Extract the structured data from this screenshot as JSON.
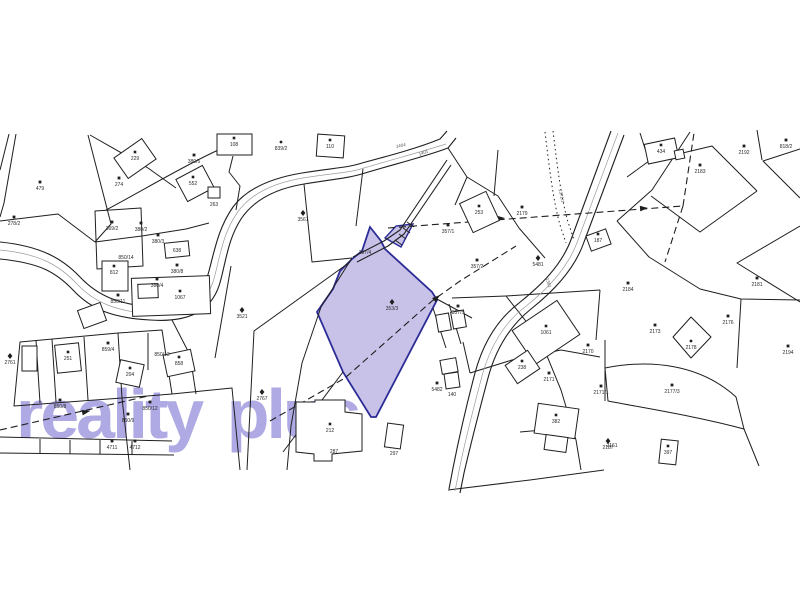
{
  "map": {
    "watermark": {
      "text": "reality plus",
      "color": "#6f66cf",
      "opacity": 0.55
    },
    "colors": {
      "background": "#ffffff",
      "line": "#1f1f1f",
      "road_center": "#9c9c9c",
      "highlight_fill": "#c8c2e9",
      "highlight_stroke": "#2c2c97",
      "label": "#2a2a2a"
    },
    "highlight": {
      "main_parcel": "M370,227 L381,241 L385,249 L432,292 L437,300 L376,417 L371,417 L343,372 L317,312 L333,289 L340,271 L352,259 L362,251 Z",
      "sliver_parcel": "M385,238 L396,226 L413,224 L401,247 Z",
      "label": "353/3"
    },
    "roads": [
      {
        "edges": [
          "M0,242 C40,246 62,258 80,277 C98,296 118,304 152,307 C188,310 202,298 209,271 C215,248 219,227 233,207 C247,188 272,178 302,173 C332,168 347,168 362,163 C392,155 418,148 440,139 L447,131",
          "M0,259 C40,263 56,272 74,291 C92,310 114,318 150,320 C192,323 214,309 221,279 C227,255 229,238 241,219 C253,201 274,189 304,184 C334,179 350,178 365,173 C395,164 424,157 448,148 L456,138"
        ],
        "center": "M0,250 C40,254 59,265 77,284 C95,303 116,311 151,314 C190,317 208,304 215,275 C221,251 224,232 237,213 C250,194 273,183 303,178 C333,173 349,173 364,168 C394,159 421,152 446,144"
      },
      {
        "edges": [
          "M611,131 L572,237 C562,266 539,287 519,303 C498,319 483,343 475,373 C467,403 459,438 453,468 L449,489",
          "M624,135 L584,242 C574,271 551,293 531,309 C511,325 496,348 488,378 C480,408 471,443 464,473 L460,493"
        ],
        "center": "M618,133 L578,240 C568,269 545,291 525,307 C505,322 490,346 482,376 C474,406 465,441 459,471 L455,491"
      },
      {
        "edges": [
          "M447,160 L400,230 L384,241 L353,257",
          "M451,165 L404,234 L388,246 L357,262"
        ],
        "center": null
      }
    ],
    "bridge_ticks": [
      "M395,240 L402,245",
      "M399,234 L406,239",
      "M403,228 L410,233",
      "M407,222 L414,227"
    ],
    "boundaries": [
      "M88,135 L111,224 L95,242",
      "M9,134 L0,170",
      "M16,134 L4,203 L0,217",
      "M95,242 L142,236 L186,229 L209,223",
      "M0,221 L58,214 L95,242",
      "M95,211 L141,208 L143,266 L97,269 Z",
      "M106,210 C140,192 180,168 214,152 L250,135",
      "M233,156 L229,172 L240,186 L236,210",
      "M90,135 L148,168 L176,188",
      "M20,342 L118,333 L122,398 L14,406 Z",
      "M36,340 L40,403",
      "M52,339 L56,402",
      "M84,337 L88,400",
      "M118,333 L162,330 L172,394 L122,398",
      "M172,394 L232,388 L240,470",
      "M122,398 L130,470",
      "M0,437 L172,441",
      "M0,453 L174,455",
      "M40,439 L40,454",
      "M70,440 L70,454",
      "M100,440 L100,454",
      "M132,441 L132,455",
      "M352,258 L321,307 L302,363 L291,426 L287,470",
      "M350,262 L254,331 L247,470",
      "M304,184 L312,262 L352,258",
      "M363,169 L356,226",
      "M435,298 L472,318",
      "M448,148 L467,177 L455,205",
      "M467,177 L498,196 L519,228",
      "M498,150 L494,196",
      "M519,228 L545,258",
      "M640,133 L649,161 L627,177",
      "M690,132 L652,190 L617,221",
      "M649,161 L712,146 L757,191",
      "M757,191 L700,232 L651,196",
      "M757,130 L762,160",
      "M800,149 L763,161 L800,198",
      "M800,226 L737,263 L800,302",
      "M617,221 L649,257 L700,289 L741,299 L800,300",
      "M741,299 L737,368",
      "M673,337 L691,317 L711,337 L691,358 Z",
      "M605,368 C650,359 700,364 736,397 L744,429 C700,417 650,409 608,401 Z",
      "M605,340 L605,401",
      "M744,429 L759,466",
      "M506,296 L540,339 L561,390 L576,440 L581,470",
      "M561,350 L600,357",
      "M470,373 L512,360 L561,350",
      "M520,432 L565,428",
      "M448,490 L530,480 L604,470",
      "M452,298 L506,296",
      "M506,296 L600,290",
      "M600,290 L596,340",
      "M433,308 L446,348",
      "M449,304 L461,344",
      "M463,342 L470,373",
      "M231,266 L215,358",
      "M343,372 L283,452",
      "M148,333 L148,370",
      "M172,320 L190,355 L196,394"
    ],
    "dotted": [
      "M545,132 C549,165 553,200 560,225 L566,243",
      "M553,131 C557,164 561,198 568,222 L574,240"
    ],
    "dashed": [
      "M388,228 L683,206",
      "M683,206 L694,133",
      "M683,206 L665,262",
      "M270,421 L345,378 L432,301 L460,281 L516,246",
      "M0,430 L148,396"
    ],
    "arrows": [
      {
        "x": 505,
        "y": 218,
        "a": -4
      },
      {
        "x": 648,
        "y": 208,
        "a": -4
      },
      {
        "x": 440,
        "y": 295,
        "a": -40
      },
      {
        "x": 90,
        "y": 411,
        "a": -12
      }
    ],
    "houses": [
      {
        "x": 118,
        "y": 146,
        "w": 34,
        "h": 25,
        "r": -35,
        "lbl": "229",
        "lx": 135,
        "ly": 160
      },
      {
        "x": 180,
        "y": 171,
        "w": 30,
        "h": 25,
        "r": -28,
        "lbl": "552",
        "lx": 193,
        "ly": 185
      },
      {
        "x": 208,
        "y": 187,
        "w": 12,
        "h": 11,
        "r": 0
      },
      {
        "x": 217,
        "y": 134,
        "w": 35,
        "h": 21,
        "r": 0,
        "lbl": "108",
        "lx": 234,
        "ly": 146
      },
      {
        "x": 317,
        "y": 135,
        "w": 27,
        "h": 22,
        "r": 4,
        "lbl": "110",
        "lx": 330,
        "ly": 148
      },
      {
        "x": 132,
        "y": 277,
        "w": 78,
        "h": 38,
        "r": -2,
        "lbl": "1067",
        "lx": 180,
        "ly": 299
      },
      {
        "x": 138,
        "y": 284,
        "w": 20,
        "h": 14,
        "r": -2
      },
      {
        "x": 102,
        "y": 261,
        "w": 26,
        "h": 30,
        "r": 0,
        "lbl": "812",
        "lx": 114,
        "ly": 274
      },
      {
        "x": 56,
        "y": 344,
        "w": 24,
        "h": 28,
        "r": -6,
        "lbl": "251",
        "lx": 68,
        "ly": 360
      },
      {
        "x": 22,
        "y": 346,
        "w": 15,
        "h": 25,
        "r": 0
      },
      {
        "x": 165,
        "y": 352,
        "w": 28,
        "h": 22,
        "r": -12,
        "lbl": "858",
        "lx": 179,
        "ly": 365
      },
      {
        "x": 118,
        "y": 362,
        "w": 24,
        "h": 23,
        "r": 12,
        "lbl": "204",
        "lx": 130,
        "ly": 376
      },
      {
        "x": 165,
        "y": 242,
        "w": 24,
        "h": 15,
        "r": -6
      },
      {
        "x": 80,
        "y": 306,
        "w": 24,
        "h": 19,
        "r": -20
      },
      {
        "x": 465,
        "y": 196,
        "w": 29,
        "h": 32,
        "r": -25,
        "lbl": "253",
        "lx": 479,
        "ly": 214
      },
      {
        "x": 646,
        "y": 141,
        "w": 31,
        "h": 20,
        "r": -12,
        "lbl": "434",
        "lx": 661,
        "ly": 153
      },
      {
        "x": 675,
        "y": 150,
        "w": 9,
        "h": 9,
        "r": -12
      },
      {
        "x": 588,
        "y": 232,
        "w": 21,
        "h": 16,
        "r": -20,
        "lbl": "187",
        "lx": 598,
        "ly": 242
      },
      {
        "x": 519,
        "y": 312,
        "w": 54,
        "h": 41,
        "r": -34,
        "lbl": "1061",
        "lx": 546,
        "ly": 334
      },
      {
        "x": 509,
        "y": 356,
        "w": 27,
        "h": 22,
        "r": -34,
        "lbl": "238",
        "lx": 522,
        "ly": 369
      },
      {
        "x": 536,
        "y": 406,
        "w": 41,
        "h": 30,
        "r": 8,
        "lbl": "382",
        "lx": 556,
        "ly": 423
      },
      {
        "x": 545,
        "y": 436,
        "w": 22,
        "h": 15,
        "r": 8
      },
      {
        "x": 437,
        "y": 314,
        "w": 13,
        "h": 17,
        "r": -10
      },
      {
        "x": 452,
        "y": 311,
        "w": 13,
        "h": 17,
        "r": -10
      },
      {
        "x": 441,
        "y": 359,
        "w": 16,
        "h": 14,
        "r": -10
      },
      {
        "x": 445,
        "y": 373,
        "w": 14,
        "h": 15,
        "r": -8
      },
      {
        "x": 325,
        "y": 427,
        "w": 20,
        "h": 18,
        "r": 40
      },
      {
        "x": 386,
        "y": 424,
        "w": 16,
        "h": 24,
        "r": 8
      },
      {
        "x": 660,
        "y": 440,
        "w": 17,
        "h": 24,
        "r": 6,
        "lbl": "397",
        "lx": 668,
        "ly": 454
      }
    ],
    "house_paths": [
      {
        "d": "M296,402 L296,452 L314,454 L314,461 L332,461 L332,454 L362,451 L362,414 L345,412 L345,400 L315,400 L315,402 Z",
        "lbl": "212",
        "lx": 330,
        "ly": 432
      }
    ],
    "labels": [
      {
        "t": "479",
        "x": 40,
        "y": 190,
        "s": "sq"
      },
      {
        "t": "278/2",
        "x": 14,
        "y": 225,
        "s": "sq"
      },
      {
        "t": "274",
        "x": 119,
        "y": 186,
        "s": "sq"
      },
      {
        "t": "263",
        "x": 214,
        "y": 206,
        "s": ""
      },
      {
        "t": "839/2",
        "x": 281,
        "y": 150,
        "s": "dot"
      },
      {
        "t": "380/5",
        "x": 194,
        "y": 163,
        "s": "sq"
      },
      {
        "t": "638",
        "x": 177,
        "y": 252,
        "s": ""
      },
      {
        "t": "3561",
        "x": 303,
        "y": 221,
        "s": "st"
      },
      {
        "t": "3521",
        "x": 242,
        "y": 318,
        "s": "st"
      },
      {
        "t": "369/2",
        "x": 112,
        "y": 230,
        "s": "sq"
      },
      {
        "t": "380/2",
        "x": 141,
        "y": 231,
        "s": "sq"
      },
      {
        "t": "380/3",
        "x": 158,
        "y": 243,
        "s": "sq"
      },
      {
        "t": "380/8",
        "x": 177,
        "y": 273,
        "s": "sq"
      },
      {
        "t": "380/4",
        "x": 157,
        "y": 287,
        "s": "sq"
      },
      {
        "t": "850/11",
        "x": 118,
        "y": 303,
        "s": "sq"
      },
      {
        "t": "850/14",
        "x": 126,
        "y": 259,
        "s": ""
      },
      {
        "t": "859/4",
        "x": 108,
        "y": 351,
        "s": "sq"
      },
      {
        "t": "850/13",
        "x": 162,
        "y": 356,
        "s": ""
      },
      {
        "t": "850/12",
        "x": 150,
        "y": 410,
        "s": "sq"
      },
      {
        "t": "850/9",
        "x": 128,
        "y": 422,
        "s": "sq"
      },
      {
        "t": "850/8",
        "x": 60,
        "y": 408,
        "s": "sq"
      },
      {
        "t": "4711",
        "x": 112,
        "y": 449,
        "s": "sq"
      },
      {
        "t": "4712",
        "x": 135,
        "y": 449,
        "s": "sq"
      },
      {
        "t": "2761",
        "x": 10,
        "y": 364,
        "s": "st"
      },
      {
        "t": "2767",
        "x": 262,
        "y": 400,
        "s": "st"
      },
      {
        "t": "357/4",
        "x": 365,
        "y": 254,
        "s": ""
      },
      {
        "t": "353/3",
        "x": 392,
        "y": 310,
        "s": "st"
      },
      {
        "t": "357/1",
        "x": 448,
        "y": 233,
        "s": "sq"
      },
      {
        "t": "357/2",
        "x": 477,
        "y": 268,
        "s": "sq"
      },
      {
        "t": "357/5",
        "x": 458,
        "y": 314,
        "s": "sq"
      },
      {
        "t": "5482",
        "x": 437,
        "y": 391,
        "s": "sq"
      },
      {
        "t": "140",
        "x": 452,
        "y": 396,
        "s": ""
      },
      {
        "t": "5481",
        "x": 538,
        "y": 266,
        "s": "st"
      },
      {
        "t": "1361",
        "x": 547,
        "y": 283,
        "s": "",
        "r": 72
      },
      {
        "t": "1404",
        "x": 401,
        "y": 147,
        "s": "",
        "r": -12
      },
      {
        "t": "1401",
        "x": 424,
        "y": 154,
        "s": "",
        "r": -22
      },
      {
        "t": "1371/1",
        "x": 560,
        "y": 196,
        "s": "",
        "r": 78
      },
      {
        "t": "2179",
        "x": 522,
        "y": 215,
        "s": "sq"
      },
      {
        "t": "2183",
        "x": 700,
        "y": 173,
        "s": "sq"
      },
      {
        "t": "2192",
        "x": 744,
        "y": 154,
        "s": "sq"
      },
      {
        "t": "818/2",
        "x": 786,
        "y": 148,
        "s": "sq"
      },
      {
        "t": "2184",
        "x": 628,
        "y": 291,
        "s": "sq"
      },
      {
        "t": "2181",
        "x": 757,
        "y": 286,
        "s": "sq"
      },
      {
        "t": "2173",
        "x": 655,
        "y": 333,
        "s": "sq"
      },
      {
        "t": "2178",
        "x": 691,
        "y": 349,
        "s": "dot"
      },
      {
        "t": "2177/3",
        "x": 672,
        "y": 393,
        "s": "sq"
      },
      {
        "t": "2187",
        "x": 608,
        "y": 449,
        "s": "st"
      },
      {
        "t": "2176",
        "x": 728,
        "y": 324,
        "s": "sq"
      },
      {
        "t": "2194",
        "x": 788,
        "y": 354,
        "s": "sq"
      },
      {
        "t": "2170",
        "x": 588,
        "y": 353,
        "s": "sq"
      },
      {
        "t": "2171",
        "x": 549,
        "y": 381,
        "s": "sq"
      },
      {
        "t": "2171/1",
        "x": 601,
        "y": 394,
        "s": "sq"
      },
      {
        "t": "2161",
        "x": 612,
        "y": 447,
        "s": ""
      },
      {
        "t": "287",
        "x": 334,
        "y": 453,
        "s": ""
      },
      {
        "t": "297",
        "x": 394,
        "y": 455,
        "s": ""
      }
    ]
  }
}
